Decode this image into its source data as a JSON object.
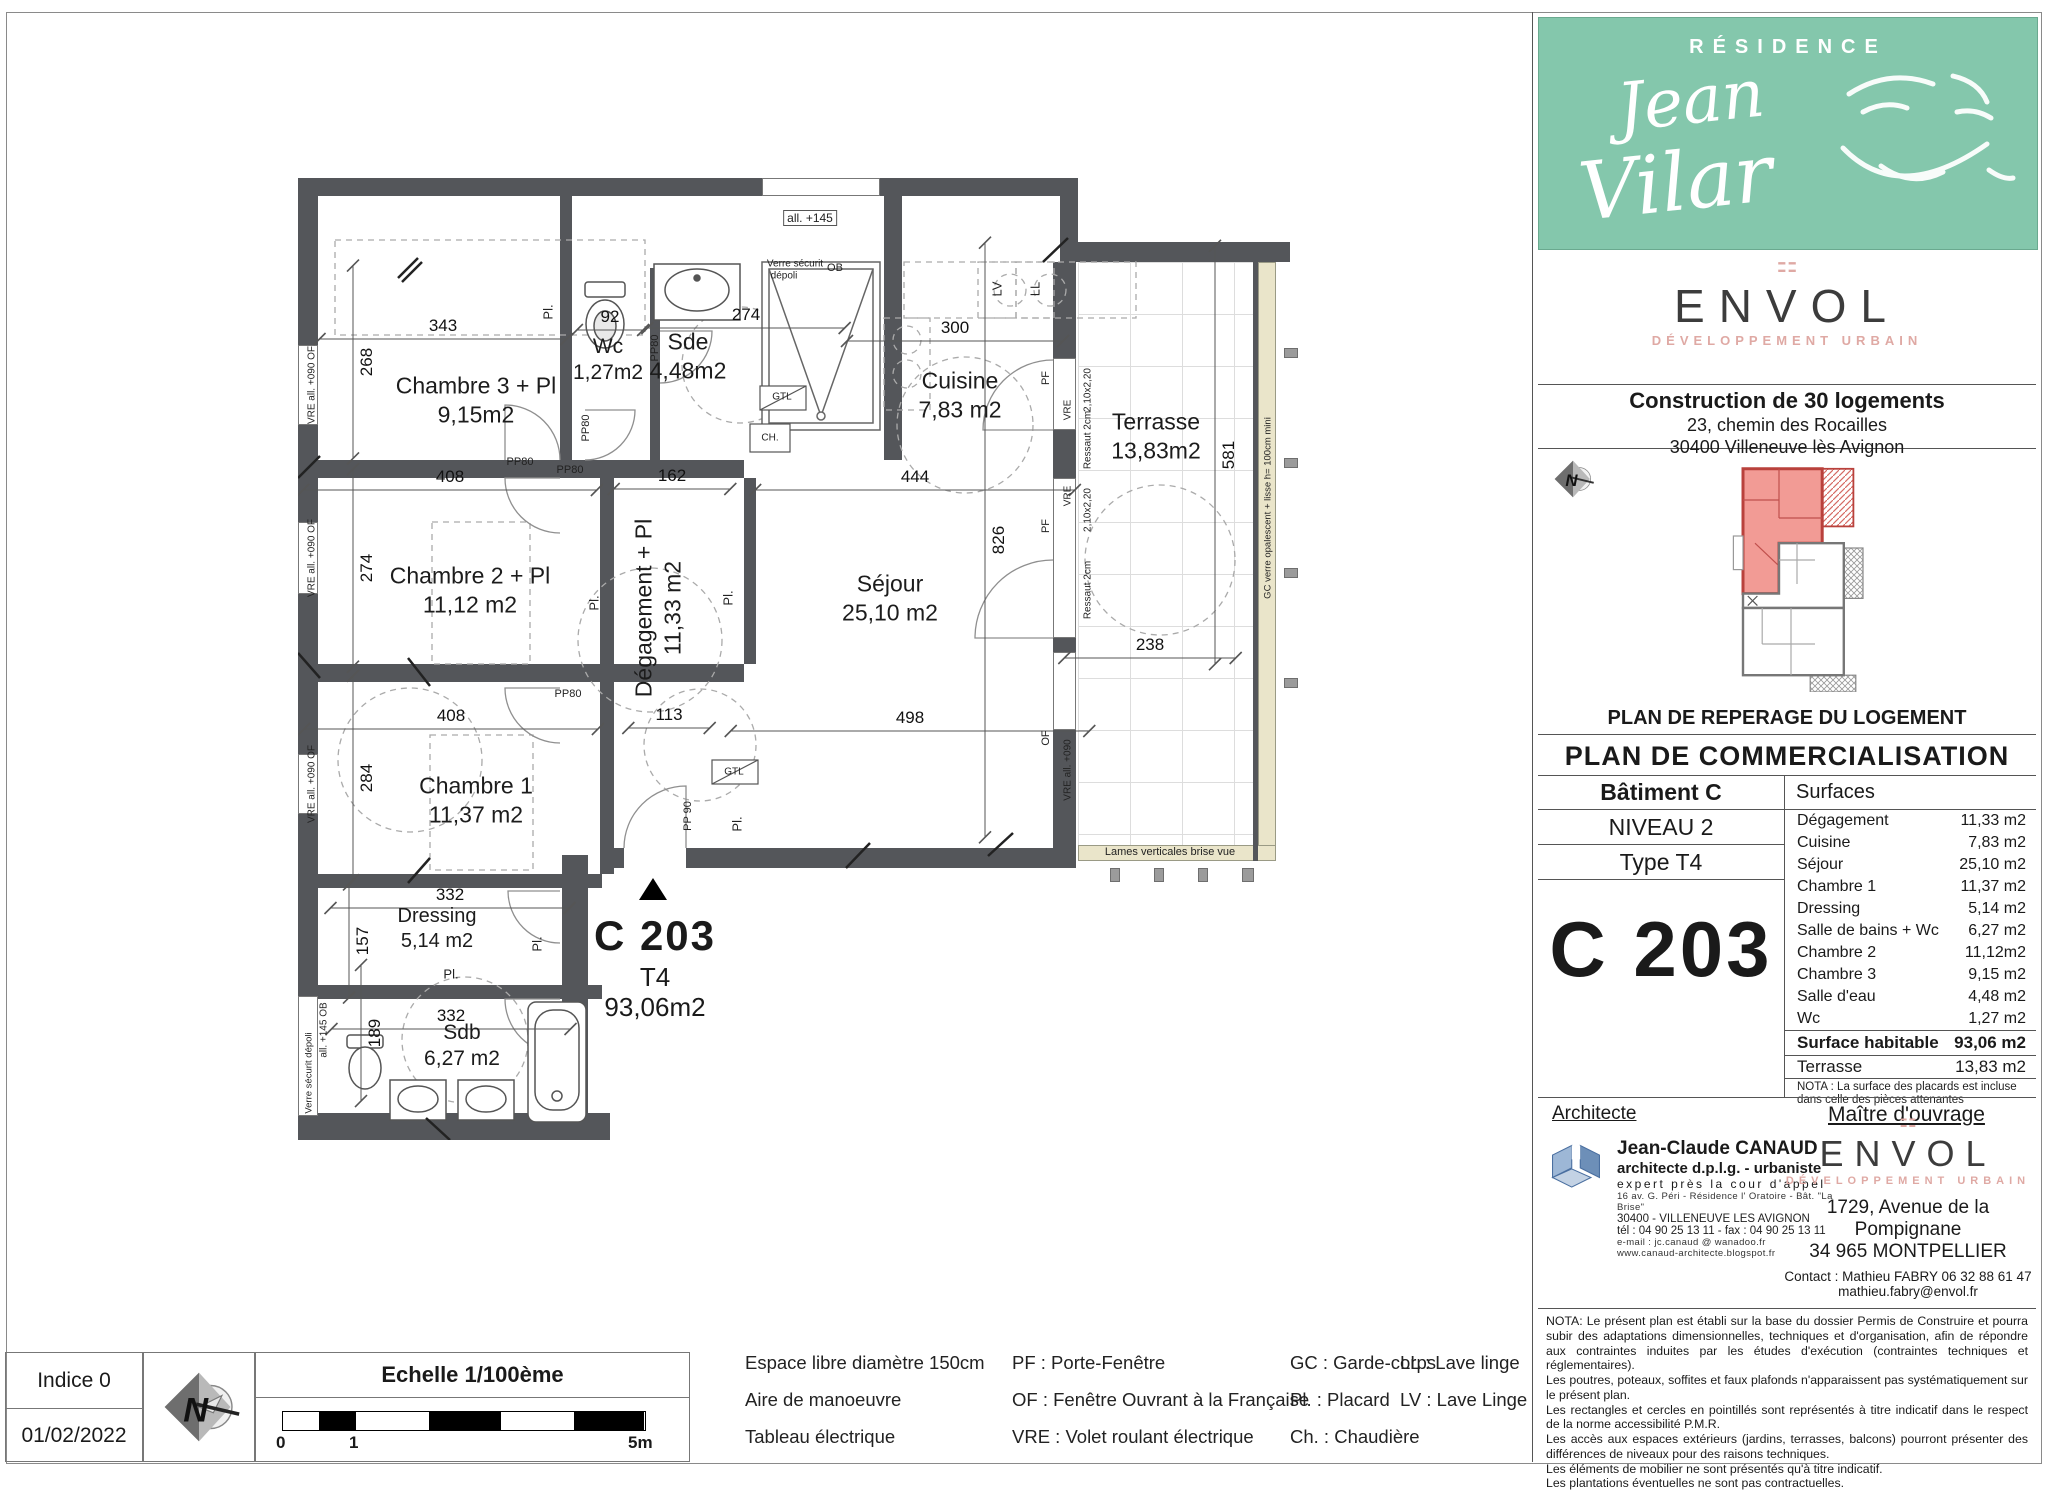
{
  "header": {
    "residence_label": "RÉSIDENCE",
    "residence_name_line1": "Jean",
    "residence_name_line2": "Vilar"
  },
  "developer": {
    "brand": "ENVOL",
    "tagline": "DÉVELOPPEMENT URBAIN"
  },
  "project": {
    "title": "Construction de 30 logements",
    "address1": "23, chemin des Rocailles",
    "address2": "30400 Villeneuve lès Avignon"
  },
  "key_plan": {
    "caption": "PLAN DE REPERAGE DU LOGEMENT"
  },
  "doc_title": "PLAN DE COMMERCIALISATION",
  "unit": {
    "building": "Bâtiment C",
    "level": "NIVEAU 2",
    "type_label": "Type T4",
    "code": "C 203"
  },
  "surfaces": {
    "header": "Surfaces",
    "rows": [
      {
        "label": "Dégagement",
        "value": "11,33 m2"
      },
      {
        "label": "Cuisine",
        "value": "7,83 m2"
      },
      {
        "label": "Séjour",
        "value": "25,10 m2"
      },
      {
        "label": "Chambre 1",
        "value": "11,37 m2"
      },
      {
        "label": "Dressing",
        "value": "5,14 m2"
      },
      {
        "label": "Salle de bains + Wc",
        "value": "6,27 m2"
      },
      {
        "label": "Chambre 2",
        "value": "11,12m2"
      },
      {
        "label": "Chambre 3",
        "value": "9,15 m2"
      },
      {
        "label": "Salle d'eau",
        "value": "4,48 m2"
      },
      {
        "label": "Wc",
        "value": "1,27 m2"
      }
    ],
    "habitable": {
      "label": "Surface habitable",
      "value": "93,06 m2"
    },
    "terrace": {
      "label": "Terrasse",
      "value": "13,83 m2"
    },
    "nota": "NOTA : La surface des placards est incluse dans celle des pièces attenantes"
  },
  "parties": {
    "architect_title": "Architecte",
    "owner_title": "Maître d'ouvrage"
  },
  "architect": {
    "name": "Jean-Claude CANAUD",
    "title1": "architecte d.p.l.g. - urbaniste",
    "title2": "expert près la cour d'appel",
    "addr1": "16 av. G. Péri - Résidence l' Oratoire - Bât. \"La Brise\"",
    "addr2": "30400 - VILLENEUVE LES AVIGNON",
    "tel": "tél : 04 90 25 13 11  -  fax : 04 90 25 13 11",
    "email": "e-mail : jc.canaud @ wanadoo.fr",
    "web": "www.canaud-architecte.blogspot.fr"
  },
  "owner": {
    "addr1": "1729, Avenue de la Pompignane",
    "addr2": "34 965 MONTPELLIER",
    "contact": "Contact :  Mathieu  FABRY 06 32 88 61 47",
    "email": "mathieu.fabry@envol.fr"
  },
  "nota_block": {
    "paragraphs": [
      "NOTA: Le présent plan est établi sur la base du dossier Permis de Construire et pourra subir des adaptations dimensionnelles, techniques et d'organisation, afin de répondre aux contraintes induites par les études d'exécution (contraintes techniques et réglementaires).",
      "Les poutres, poteaux, soffites et faux plafonds  n'apparaissent pas  systématiquement sur le présent plan.",
      "Les rectangles et cercles en pointillés sont représentés à titre indicatif dans le respect de la norme accessibilité P.M.R.",
      "Les accès aux espaces extérieurs (jardins, terrasses, balcons) pourront présenter des différences de niveaux pour des raisons techniques.",
      "Les éléments de mobilier ne sont présentés qu'à titre indicatif.",
      "Les plantations éventuelles ne sont pas contractuelles."
    ]
  },
  "title_block": {
    "indice": "Indice 0",
    "date": "01/02/2022",
    "scale_label": "Echelle 1/100ème",
    "tick0": "0",
    "tick1": "1",
    "tick5": "5m"
  },
  "legend": {
    "col1": [
      "Espace libre diamètre 150cm",
      "Aire de manoeuvre",
      "Tableau électrique"
    ],
    "col2": [
      "PF : Porte-Fenêtre",
      "OF : Fenêtre Ouvrant à la Française",
      "VRE : Volet roulant électrique"
    ],
    "col3": [
      "GC : Garde-corps",
      "Pl. : Placard",
      "Ch. : Chaudière"
    ],
    "col4": [
      "LL : Lave linge",
      "LV : Lave Linge"
    ]
  },
  "plan": {
    "unit_marker": {
      "code": "C 203",
      "type": "T4",
      "area": "93,06m2"
    },
    "rooms": [
      {
        "name": "Chambre 3 + Pl",
        "area": "9,15m2",
        "x": 178,
        "y": 222
      },
      {
        "name": "Wc",
        "area": "1,27m2",
        "x": 310,
        "y": 182,
        "s": 21
      },
      {
        "name": "Sde",
        "area": "4,48m2",
        "x": 390,
        "y": 178,
        "s": 23
      },
      {
        "name": "Cuisine",
        "area": "7,83 m2",
        "x": 662,
        "y": 217
      },
      {
        "name": "Terrasse",
        "area": "13,83m2",
        "x": 858,
        "y": 258
      },
      {
        "name": "Chambre 2 + Pl",
        "area": "11,12 m2",
        "x": 172,
        "y": 412
      },
      {
        "name": "Dégagement + Pl",
        "area": "11,33 m2",
        "x": 360,
        "y": 430,
        "r": -90
      },
      {
        "name": "Séjour",
        "area": "25,10 m2",
        "x": 592,
        "y": 420
      },
      {
        "name": "Chambre 1",
        "area": "11,37 m2",
        "x": 178,
        "y": 622
      },
      {
        "name": "Dressing",
        "area": "5,14 m2",
        "x": 139,
        "y": 751,
        "s": 20
      },
      {
        "name": "Sdb",
        "area": "6,27 m2",
        "x": 164,
        "y": 868,
        "s": 21
      }
    ],
    "dims": [
      {
        "t": "343",
        "x": 145,
        "y": 148
      },
      {
        "t": "92",
        "x": 312,
        "y": 139
      },
      {
        "t": "274",
        "x": 448,
        "y": 137
      },
      {
        "t": "300",
        "x": 657,
        "y": 150
      },
      {
        "t": "408",
        "x": 152,
        "y": 299
      },
      {
        "t": "162",
        "x": 374,
        "y": 298
      },
      {
        "t": "444",
        "x": 617,
        "y": 299
      },
      {
        "t": "408",
        "x": 153,
        "y": 538
      },
      {
        "t": "113",
        "x": 371,
        "y": 537
      },
      {
        "t": "498",
        "x": 612,
        "y": 540
      },
      {
        "t": "238",
        "x": 852,
        "y": 467
      },
      {
        "t": "332",
        "x": 152,
        "y": 717
      },
      {
        "t": "332",
        "x": 153,
        "y": 838
      },
      {
        "t": "268",
        "x": 69,
        "y": 184,
        "v": 1
      },
      {
        "t": "274",
        "x": 69,
        "y": 390,
        "v": 1
      },
      {
        "t": "284",
        "x": 69,
        "y": 600,
        "v": 1
      },
      {
        "t": "826",
        "x": 701,
        "y": 362,
        "v": 1
      },
      {
        "t": "581",
        "x": 931,
        "y": 277,
        "v": 1
      },
      {
        "t": "157",
        "x": 65,
        "y": 763,
        "v": 1
      },
      {
        "t": "189",
        "x": 77,
        "y": 855,
        "v": 1
      }
    ],
    "labels": [
      {
        "t": "VRE   all. +090   OF",
        "x": 14,
        "y": 207,
        "r": -90,
        "s": 10
      },
      {
        "t": "VRE   all. +090   OF",
        "x": 14,
        "y": 380,
        "r": -90,
        "s": 10
      },
      {
        "t": "VRE   all. +090   OF",
        "x": 14,
        "y": 606,
        "r": -90,
        "s": 10
      },
      {
        "t": "all. +145   OB",
        "x": 26,
        "y": 852,
        "r": -90,
        "s": 10
      },
      {
        "t": "Verre sécurit dépoli",
        "x": 11,
        "y": 895,
        "r": -90,
        "s": 9.5
      },
      {
        "t": "all. +145",
        "x": 512,
        "y": 40,
        "s": 12,
        "box": 1
      },
      {
        "t": "Verre sécurit",
        "x": 497,
        "y": 86,
        "s": 10
      },
      {
        "t": "dépoli",
        "x": 486,
        "y": 98,
        "s": 10
      },
      {
        "t": "OB",
        "x": 537,
        "y": 90,
        "s": 11
      },
      {
        "t": "PP80",
        "x": 222,
        "y": 284,
        "s": 11
      },
      {
        "t": "PP80",
        "x": 272,
        "y": 292,
        "s": 11
      },
      {
        "t": "PP80",
        "x": 270,
        "y": 516,
        "s": 11
      },
      {
        "t": "PP80",
        "x": 288,
        "y": 250,
        "r": -90,
        "s": 11
      },
      {
        "t": "PP80",
        "x": 357,
        "y": 170,
        "r": -90,
        "s": 11
      },
      {
        "t": "PP 90",
        "x": 390,
        "y": 638,
        "r": -90,
        "s": 11
      },
      {
        "t": "Pl.",
        "x": 250,
        "y": 134,
        "r": -90,
        "s": 13
      },
      {
        "t": "Pl.",
        "x": 296,
        "y": 425,
        "r": -90,
        "s": 13
      },
      {
        "t": "Pl.",
        "x": 430,
        "y": 420,
        "r": -90,
        "s": 13
      },
      {
        "t": "Pl.",
        "x": 439,
        "y": 646,
        "r": -90,
        "s": 13
      },
      {
        "t": "Pl.",
        "x": 239,
        "y": 766,
        "r": -90,
        "s": 13
      },
      {
        "t": "Pl.",
        "x": 153,
        "y": 796,
        "s": 13
      },
      {
        "t": "GTL",
        "x": 484,
        "y": 219,
        "s": 10
      },
      {
        "t": "GTL",
        "x": 436,
        "y": 594,
        "s": 10
      },
      {
        "t": "CH.",
        "x": 472,
        "y": 260,
        "s": 10
      },
      {
        "t": "LV",
        "x": 699,
        "y": 111,
        "r": -90,
        "s": 13
      },
      {
        "t": "LL",
        "x": 737,
        "y": 111,
        "r": -90,
        "s": 13
      },
      {
        "t": "PF",
        "x": 748,
        "y": 200,
        "r": -90,
        "s": 11
      },
      {
        "t": "VRE",
        "x": 770,
        "y": 232,
        "r": -90,
        "s": 10
      },
      {
        "t": "2,10x2,20",
        "x": 790,
        "y": 212,
        "r": -90,
        "s": 10
      },
      {
        "t": "Ressaut 2cm",
        "x": 790,
        "y": 262,
        "r": -90,
        "s": 10
      },
      {
        "t": "PF",
        "x": 748,
        "y": 348,
        "r": -90,
        "s": 11
      },
      {
        "t": "VRE",
        "x": 770,
        "y": 318,
        "r": -90,
        "s": 10
      },
      {
        "t": "2,10x2,20",
        "x": 790,
        "y": 332,
        "r": -90,
        "s": 10
      },
      {
        "t": "Ressaut 2cm",
        "x": 790,
        "y": 412,
        "r": -90,
        "s": 10
      },
      {
        "t": "OF",
        "x": 748,
        "y": 560,
        "r": -90,
        "s": 11
      },
      {
        "t": "VRE   all. +090",
        "x": 770,
        "y": 592,
        "r": -90,
        "s": 10
      },
      {
        "t": "GC verre opalescent + lisse h= 100cm mini",
        "x": 970,
        "y": 330,
        "r": -90,
        "s": 9.5
      },
      {
        "t": "Lames verticales brise vue",
        "x": 872,
        "y": 674,
        "s": 11
      }
    ]
  }
}
